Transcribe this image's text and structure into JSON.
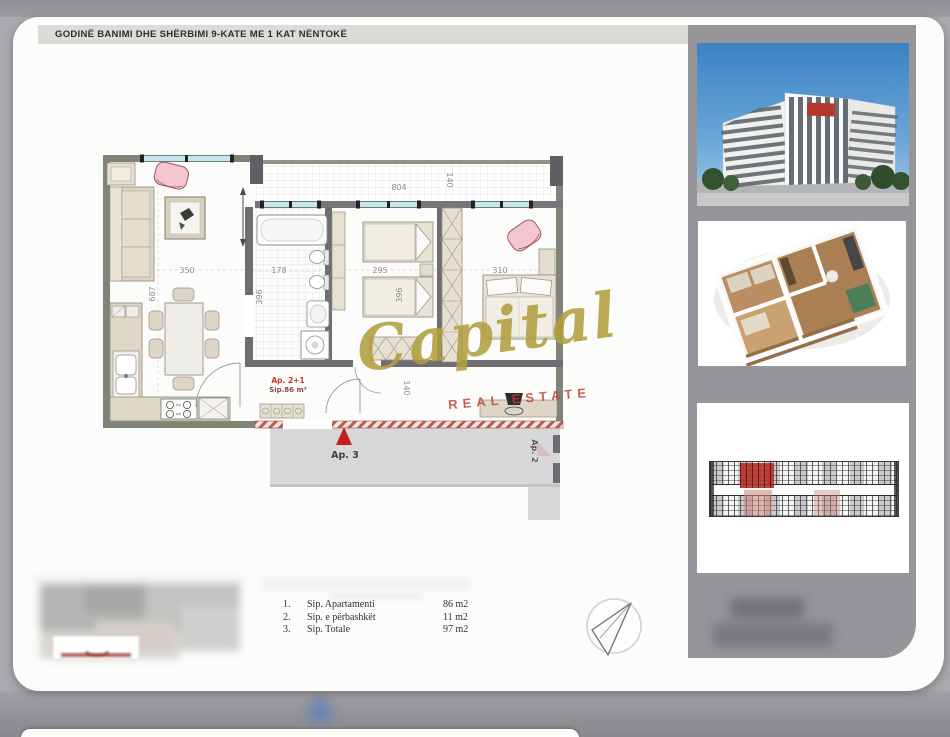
{
  "header": {
    "title": "GODINË BANIMI DHE SHËRBIMI 9-KATE ME 1 KAT NËNTOKË"
  },
  "plan": {
    "unit_label": "Ap. 2+1",
    "unit_area": "Sip.86 m²",
    "marker_ap3": "Ap. 3",
    "marker_ap2": "Ap. 2",
    "dims": {
      "living_width": "350",
      "living_depth": "687",
      "bath_width": "178",
      "bath_depth": "396",
      "bedroom1_width": "295",
      "bedroom1_depth": "396",
      "bedroom2_width": "310",
      "balcony_length": "804",
      "balcony_depth": "140",
      "hall_depth": "140"
    }
  },
  "watermark": {
    "brand": "Capital",
    "tagline": "REAL ESTATE"
  },
  "legend": {
    "items": [
      {
        "no": "1.",
        "label": "Sip. Apartamenti",
        "value": "86 m2"
      },
      {
        "no": "2.",
        "label": "Sip. e përbashkët",
        "value": "11 m2"
      },
      {
        "no": "3.",
        "label": "Sip. Totale",
        "value": "97 m2"
      }
    ]
  },
  "sidebar": {
    "images": [
      {
        "name": "building-exterior-render"
      },
      {
        "name": "apartment-3d-floorplan-render"
      },
      {
        "name": "floor-key-plan"
      }
    ]
  },
  "icons": {
    "north_arrow": "compass-north-arrow",
    "entrance_marker": "red-triangle"
  },
  "colors": {
    "accent_red": "#c0392b",
    "marker_red": "#c41f1f",
    "watermark_gold": "#b3a144",
    "window_cyan": "#c3e9ec",
    "outer_wall_green": "#7e8576",
    "inner_wall_gray": "#6e6e72",
    "furniture_beige": "#ddd6c7",
    "armchair_pink": "#f4c6d0",
    "corridor_gray": "#d8d8da"
  }
}
